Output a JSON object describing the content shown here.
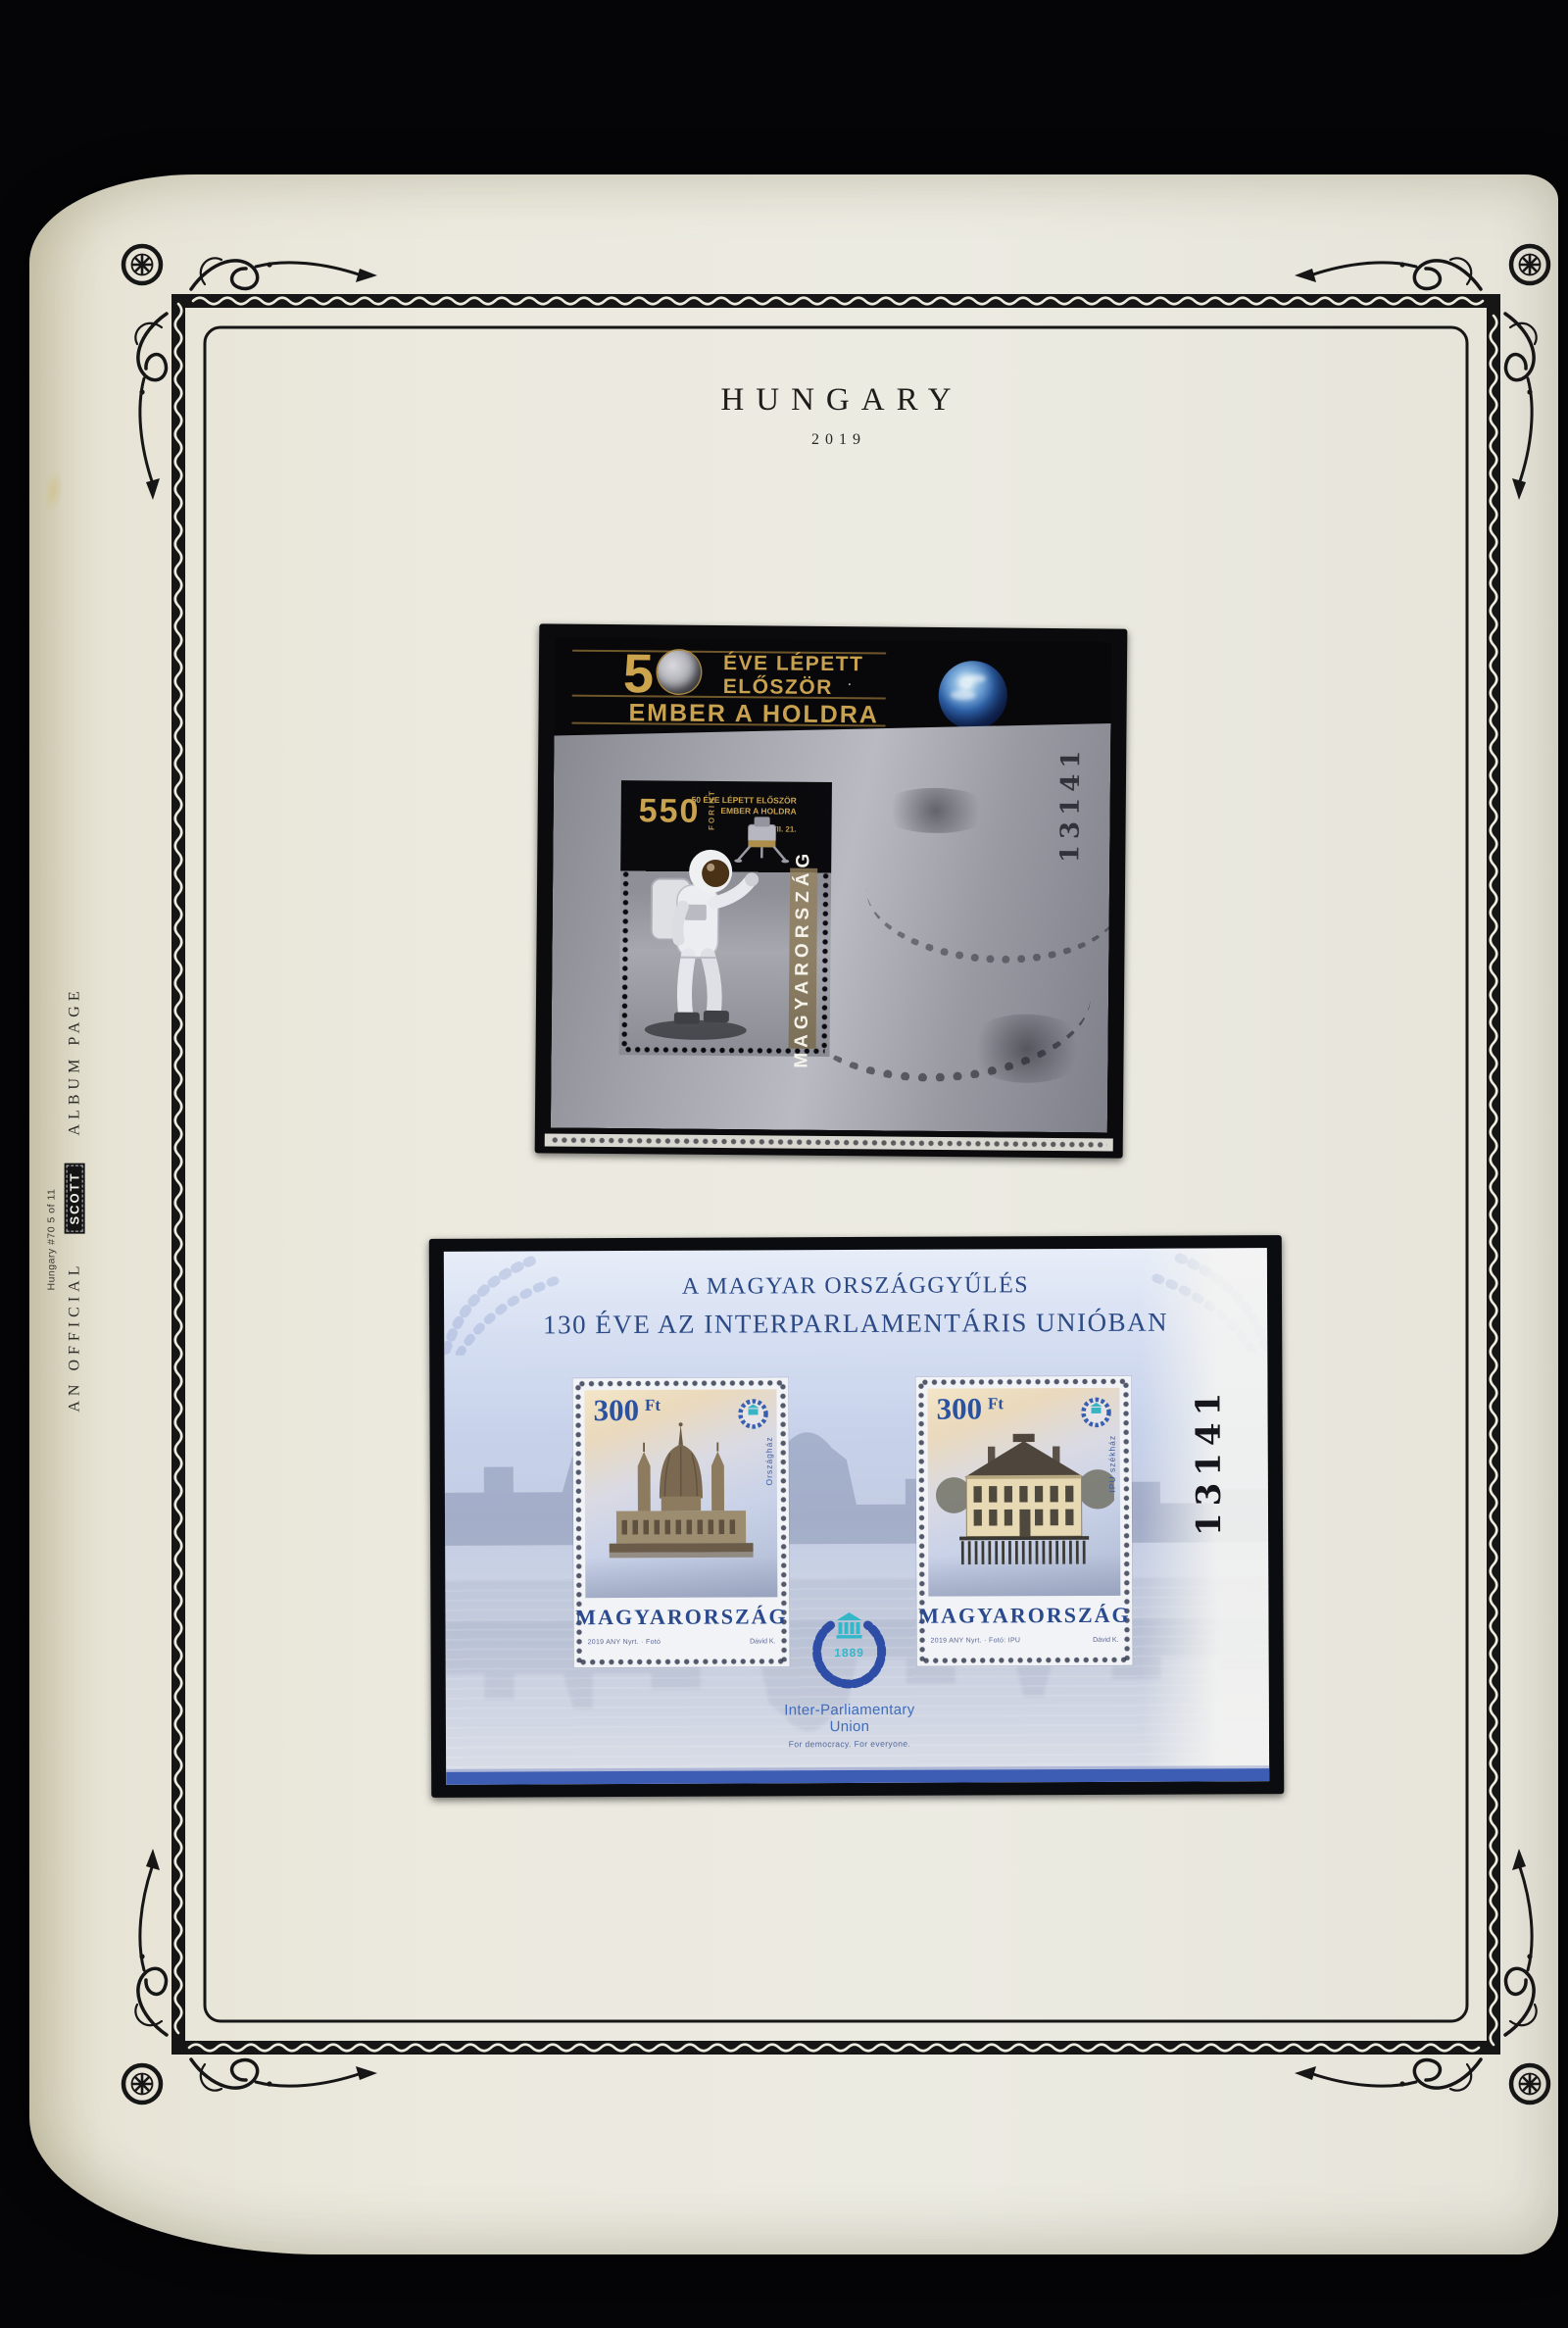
{
  "album_page": {
    "title": "HUNGARY",
    "year": "2019",
    "edge": {
      "an_official": "AN OFFICIAL",
      "brand": "SCOTT",
      "album_page": "ALBUM PAGE",
      "page_ref": "Hungary #70  5 of 11"
    }
  },
  "moon_sheet": {
    "serial": "13141",
    "big_five": "5",
    "headline": {
      "line1": "ÉVE LÉPETT",
      "line2": "ELŐSZÖR",
      "line3": "EMBER A HOLDRA"
    },
    "stamp": {
      "value": "550",
      "currency": "FORINT",
      "caption1": "50 ÉVE LÉPETT ELŐSZÖR",
      "caption2": "EMBER A HOLDRA",
      "date": "1969. VII. 21.",
      "country": "MAGYARORSZÁG"
    }
  },
  "ipu_sheet": {
    "serial": "13141",
    "title1": "A MAGYAR ORSZÁGGYŰLÉS",
    "title2": "130 ÉVE AZ INTERPARLAMENTÁRIS UNIÓBAN",
    "emblem": {
      "year": "1889",
      "org": "Inter-Parliamentary Union",
      "tagline": "For democracy. For everyone."
    },
    "stamps": [
      {
        "value": "300",
        "currency": "Ft",
        "side_label": "Országház",
        "country": "MAGYARORSZÁG",
        "imprint": "2019 ANY Nyrt. · Fotó",
        "designer": "Dávid K."
      },
      {
        "value": "300",
        "currency": "Ft",
        "side_label": "IPU székház",
        "country": "MAGYARORSZÁG",
        "imprint": "2019 ANY Nyrt. · Fotó: IPU",
        "designer": "Dávid K."
      }
    ]
  },
  "colors": {
    "background": "#050507",
    "page_cream": "#ecebe2",
    "frame_ink": "#161616",
    "gold": "#c9a24f",
    "mount_black": "#0b0b0e",
    "title_blue": "#2c4a86",
    "value_blue": "#2b52a0",
    "teal": "#35b7c9",
    "band_blue": "#3d5cb4"
  }
}
